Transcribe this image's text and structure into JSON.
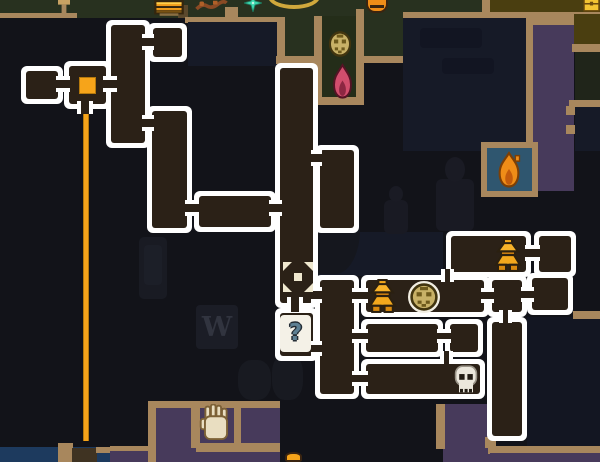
{
  "screen": {
    "kind": "dungeon-map-overlay",
    "width": 600,
    "height": 462
  },
  "colors": {
    "void": "#121319",
    "unexplored": "#161a27",
    "unexplored_dark": "#131622",
    "room_fill": "#2b2117",
    "room_border": "#ffffff",
    "tan": "#a8875d",
    "olive": "#28311f",
    "olive_dark": "#242d19",
    "olive_deep": "#20251a",
    "gold_floor": "#4a3e10",
    "purple": "#473a5b",
    "blue_room": "#2f566f",
    "blue_floor": "#1d3a5e",
    "orange": "#f6a41a",
    "orange_deep": "#b5790d",
    "outline_dark": "#2b2010",
    "cream": "#efe8cf",
    "pink": "#d14e6d",
    "pink_core": "#8c2742",
    "pink_outline": "#551325",
    "flame_orange": "#ef8d18",
    "flame_core": "#c35b0c",
    "flame_outline": "#7c3f06",
    "gold_face": "#c8b167",
    "face_marks": "#6e5a1c",
    "face_outline": "#42350f",
    "bone": "#ebe7dc",
    "bone_dark": "#221c14",
    "hand_fill": "#e9dec1",
    "hand_outline": "#7c6136",
    "q_bg": "#f4f1e7",
    "q_glyph": "#5d8093",
    "teal": "#3bd7ad",
    "arc_gold": "#d0a83c",
    "wood": "#8a4a24",
    "trunk": "#5a482c",
    "anvil": "#3f3322",
    "decor": "#191b23",
    "decor2": "#232633",
    "sign_bg": "#1b1d26",
    "sign_text": "#31343f"
  },
  "world": {
    "sign_text": "W",
    "areas": [
      [
        "olive-strip",
        0,
        0,
        488,
        18,
        "olive"
      ],
      [
        "tan-ledge-left",
        0,
        13,
        77,
        5,
        "tan"
      ],
      [
        "tree-trunk",
        178,
        5,
        10,
        13,
        "trunk"
      ],
      [
        "gold-strip",
        487,
        0,
        113,
        13,
        "gold_floor"
      ],
      [
        "tan-under-gold",
        487,
        12,
        113,
        7,
        "tan"
      ],
      [
        "tan-stub-mid-top",
        482,
        0,
        8,
        14,
        "tan"
      ],
      [
        "tan-wall-a",
        185,
        17,
        95,
        6,
        "tan"
      ],
      [
        "tan-stub-a",
        225,
        7,
        13,
        11,
        "tan"
      ],
      [
        "unexplored-1",
        188,
        22,
        89,
        44,
        "unexplored"
      ],
      [
        "tan-stub-f",
        277,
        17,
        8,
        41,
        "tan"
      ],
      [
        "olive-f",
        285,
        17,
        30,
        41,
        "olive"
      ],
      [
        "tan-band-f",
        276,
        56,
        42,
        8,
        "tan"
      ],
      [
        "niche-left-wall",
        314,
        16,
        8,
        88,
        "tan"
      ],
      [
        "niche-floor",
        322,
        16,
        34,
        86,
        "olive_dark"
      ],
      [
        "niche-right-wall",
        356,
        9,
        8,
        95,
        "tan"
      ],
      [
        "niche-bottom-wall",
        314,
        97,
        50,
        8,
        "tan"
      ],
      [
        "olive-alcove",
        364,
        17,
        39,
        41,
        "olive"
      ],
      [
        "tan-alcove-bottom",
        360,
        56,
        44,
        7,
        "tan"
      ],
      [
        "tan-wall-b",
        403,
        12,
        90,
        7,
        "tan"
      ],
      [
        "unexplored-2",
        403,
        18,
        129,
        133,
        "unexplored"
      ],
      [
        "purple-column",
        532,
        24,
        42,
        167,
        "purple"
      ],
      [
        "tan-purple-left",
        526,
        19,
        7,
        172,
        "tan"
      ],
      [
        "tan-purple-top",
        526,
        18,
        74,
        7,
        "tan"
      ],
      [
        "gold-box-right",
        574,
        14,
        26,
        33,
        "gold_floor"
      ],
      [
        "tan-right-1",
        572,
        44,
        28,
        8,
        "tan"
      ],
      [
        "olive-right",
        575,
        52,
        25,
        50,
        "olive_deep"
      ],
      [
        "tan-right-2",
        569,
        100,
        31,
        8,
        "tan"
      ],
      [
        "unexplored-right",
        575,
        107,
        25,
        44,
        "unexplored"
      ],
      [
        "tan-stub-r1",
        566,
        106,
        9,
        9,
        "tan"
      ],
      [
        "tan-stub-r2",
        566,
        125,
        9,
        9,
        "tan"
      ],
      [
        "shrine-frame",
        481,
        142,
        57,
        55,
        "tan"
      ],
      [
        "shrine-floor",
        487,
        148,
        45,
        43,
        "blue_room"
      ],
      [
        "unexplored-3",
        318,
        232,
        125,
        44,
        "unexplored"
      ],
      [
        "unexplored-4",
        527,
        317,
        73,
        130,
        "unexplored_dark"
      ],
      [
        "tan-r3",
        573,
        311,
        27,
        8,
        "tan"
      ],
      [
        "purple-bottom",
        148,
        402,
        132,
        60,
        "purple"
      ],
      [
        "tan-pb-top",
        148,
        401,
        132,
        7,
        "tan"
      ],
      [
        "tan-pb-left",
        148,
        401,
        8,
        61,
        "tan"
      ],
      [
        "tan-pb-div1",
        191,
        403,
        9,
        45,
        "tan"
      ],
      [
        "tan-pb-div2",
        234,
        403,
        7,
        42,
        "tan"
      ],
      [
        "tan-pb-bottom",
        196,
        443,
        84,
        9,
        "tan"
      ],
      [
        "tan-ps-top",
        110,
        446,
        38,
        6,
        "tan"
      ],
      [
        "purple-small",
        110,
        451,
        38,
        11,
        "purple"
      ],
      [
        "blue-floor",
        0,
        447,
        110,
        15,
        "blue_floor"
      ],
      [
        "tan-pillar-bottom",
        58,
        443,
        15,
        19,
        "tan"
      ],
      [
        "anvil-block",
        72,
        448,
        25,
        14,
        "anvil"
      ],
      [
        "tan-bit",
        96,
        447,
        14,
        6,
        "tan"
      ],
      [
        "purple-col-bottom",
        443,
        404,
        49,
        58,
        "purple"
      ],
      [
        "tan-pcb-left",
        436,
        404,
        9,
        45,
        "tan"
      ],
      [
        "tan-pcb-stub",
        485,
        437,
        11,
        11,
        "tan"
      ],
      [
        "tan-bottom-right",
        488,
        446,
        112,
        8,
        "tan"
      ],
      [
        "purple-bottom-right",
        490,
        453,
        110,
        9,
        "purple"
      ]
    ],
    "decor": [
      [
        "lantern",
        139,
        237,
        28,
        62
      ],
      [
        "plant",
        298,
        162,
        62,
        112
      ],
      [
        "figure",
        380,
        186,
        32,
        48
      ],
      [
        "figure",
        432,
        157,
        46,
        74
      ],
      [
        "barrels",
        238,
        352,
        68,
        48
      ],
      [
        "sign",
        196,
        305,
        42,
        44
      ],
      [
        "shadow-blob",
        420,
        28,
        62,
        20
      ],
      [
        "shadow-blob",
        442,
        58,
        52,
        16
      ]
    ],
    "props": [
      [
        "chest",
        154,
        0,
        30,
        16
      ],
      [
        "candlestick",
        56,
        0,
        16,
        16
      ],
      [
        "branch",
        195,
        0,
        33,
        12
      ],
      [
        "sparkle",
        244,
        -6,
        18,
        18
      ],
      [
        "arc",
        268,
        -16,
        52,
        25
      ],
      [
        "pot",
        366,
        -3,
        22,
        16
      ],
      [
        "chest-gold",
        583,
        -2,
        17,
        14
      ],
      [
        "face",
        327,
        29,
        26,
        30,
        {
          "ring": false
        }
      ],
      [
        "flame-pink",
        329,
        63,
        27,
        37
      ],
      [
        "flame-orange",
        494,
        151,
        30,
        38
      ],
      [
        "hand",
        199,
        404,
        34,
        38
      ],
      [
        "ember",
        285,
        452,
        17,
        10
      ]
    ]
  },
  "map": {
    "question_glyph": "?",
    "trail": [
      83,
      107,
      6,
      334
    ],
    "rooms": [
      [
        "room-a",
        21,
        66,
        42,
        38
      ],
      [
        "room-b-player",
        64,
        61,
        47,
        48
      ],
      [
        "room-c",
        106,
        20,
        44,
        128
      ],
      [
        "room-t",
        148,
        23,
        39,
        39
      ],
      [
        "room-d",
        147,
        106,
        45,
        127
      ],
      [
        "room-e",
        194,
        191,
        82,
        41
      ],
      [
        "corridor-f",
        275,
        63,
        43,
        245
      ],
      [
        "room-question",
        275,
        308,
        43,
        53
      ],
      [
        "room-g",
        315,
        145,
        44,
        88
      ],
      [
        "room-m",
        315,
        275,
        44,
        124
      ],
      [
        "room-j",
        361,
        275,
        128,
        42
      ],
      [
        "room-k",
        487,
        275,
        40,
        42
      ],
      [
        "room-l",
        527,
        273,
        46,
        42
      ],
      [
        "room-h-bell",
        446,
        231,
        85,
        46
      ],
      [
        "room-i",
        534,
        231,
        42,
        46
      ],
      [
        "room-n",
        361,
        319,
        82,
        38
      ],
      [
        "room-n2",
        445,
        319,
        38,
        38
      ],
      [
        "room-o-skull",
        361,
        359,
        124,
        40
      ],
      [
        "room-p",
        487,
        317,
        40,
        124
      ]
    ],
    "doors": [
      [
        56,
        76,
        14,
        16,
        "h"
      ],
      [
        103,
        76,
        14,
        16,
        "h"
      ],
      [
        142,
        34,
        12,
        16,
        "h"
      ],
      [
        142,
        115,
        12,
        16,
        "h"
      ],
      [
        185,
        200,
        14,
        16,
        "h"
      ],
      [
        269,
        200,
        13,
        16,
        "h"
      ],
      [
        311,
        150,
        11,
        16,
        "h"
      ],
      [
        311,
        287,
        11,
        16,
        "h"
      ],
      [
        287,
        297,
        16,
        15,
        "v"
      ],
      [
        311,
        341,
        11,
        15,
        "h"
      ],
      [
        352,
        288,
        16,
        15,
        "h"
      ],
      [
        481,
        288,
        13,
        15,
        "h"
      ],
      [
        521,
        287,
        13,
        15,
        "h"
      ],
      [
        525,
        245,
        15,
        16,
        "h"
      ],
      [
        441,
        269,
        13,
        13,
        "v"
      ],
      [
        499,
        310,
        13,
        13,
        "v"
      ],
      [
        352,
        329,
        16,
        14,
        "h"
      ],
      [
        437,
        329,
        14,
        14,
        "h"
      ],
      [
        440,
        351,
        13,
        13,
        "v"
      ],
      [
        352,
        371,
        16,
        15,
        "h"
      ],
      [
        77,
        101,
        16,
        13,
        "v"
      ]
    ],
    "markers": [
      [
        "player",
        79,
        77,
        17,
        17
      ],
      [
        "xmarker",
        283,
        262,
        30,
        30
      ],
      [
        "question",
        280,
        315,
        31,
        37
      ],
      [
        "bell",
        492,
        238,
        32,
        35
      ],
      [
        "bell",
        366,
        279,
        33,
        35
      ],
      [
        "face",
        408,
        281,
        32,
        32,
        {
          "ring": true
        }
      ],
      [
        "skull",
        450,
        363,
        32,
        34
      ]
    ]
  }
}
